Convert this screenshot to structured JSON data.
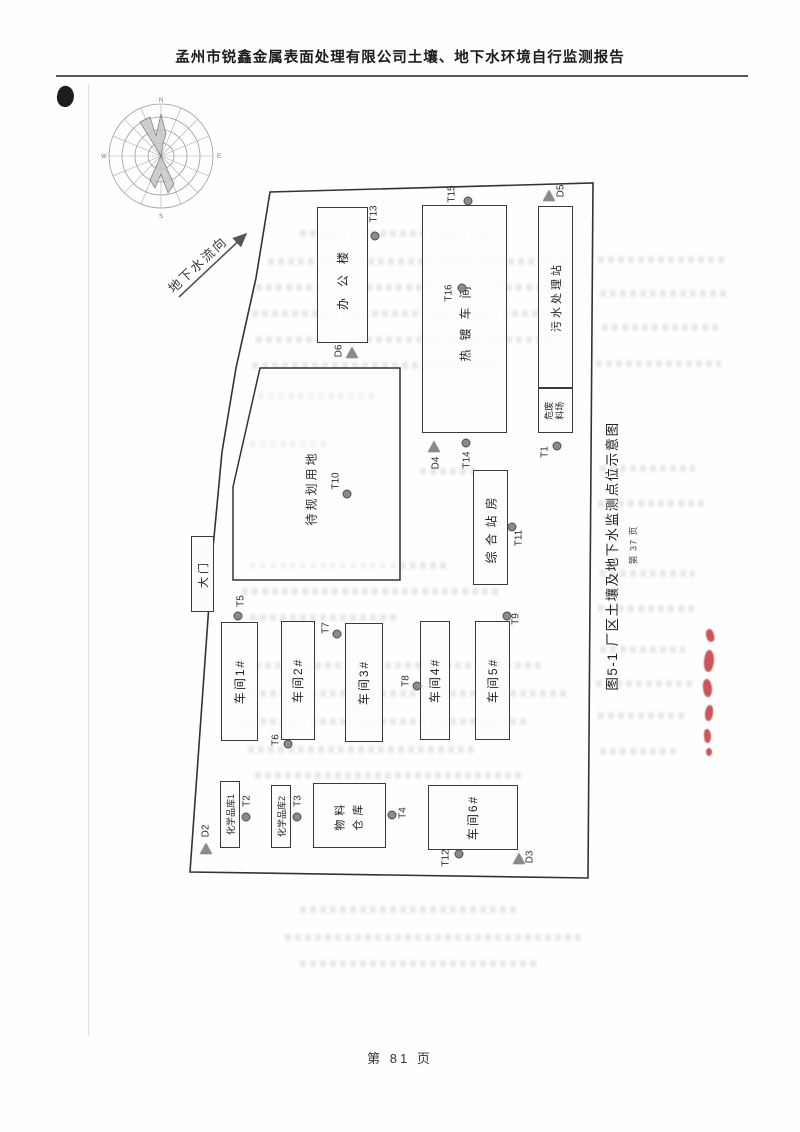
{
  "header": {
    "title": "孟州市锐鑫金属表面处理有限公司土壤、地下水环境自行监测报告"
  },
  "footer": {
    "page_label": "第 81 页"
  },
  "figure": {
    "caption": "图5-1 厂区土壤及地下水监测点位示意图",
    "source_page_label": "第 37 页",
    "groundwater_flow_label": "地下水流向",
    "gate_label": "大门",
    "compass": {
      "n": "N",
      "e": "E",
      "s": "S",
      "w": "W"
    },
    "buildings": {
      "office": "办公楼",
      "plating_workshop": "热镀车间",
      "sewage_treatment_station": "污水处理站",
      "hazwaste_yard_line1": "危废",
      "hazwaste_yard_line2": "料场",
      "planned_land": "待规划用地",
      "composite_station": "综合站房",
      "workshop_1": "车间1#",
      "workshop_2": "车间2#",
      "workshop_3": "车间3#",
      "workshop_4": "车间4#",
      "workshop_5": "车间5#",
      "workshop_6": "车间6#",
      "chemical_storehouse_1": "化学品库1",
      "chemical_storehouse_2": "化学品库2",
      "material_warehouse_line1": "物料",
      "material_warehouse_line2": "仓库"
    },
    "soil_points": {
      "t1": "T1",
      "t2": "T2",
      "t3": "T3",
      "t4": "T4",
      "t5": "T5",
      "t6": "T6",
      "t7": "T7",
      "t8": "T8",
      "t9": "T9",
      "t10": "T10",
      "t11": "T11",
      "t12": "T12",
      "t13": "T13",
      "t14": "T14",
      "t15": "T15",
      "t16": "T16"
    },
    "groundwater_points": {
      "d2": "D2",
      "d3": "D3",
      "d4": "D4",
      "d5": "D5",
      "d6": "D6"
    }
  }
}
